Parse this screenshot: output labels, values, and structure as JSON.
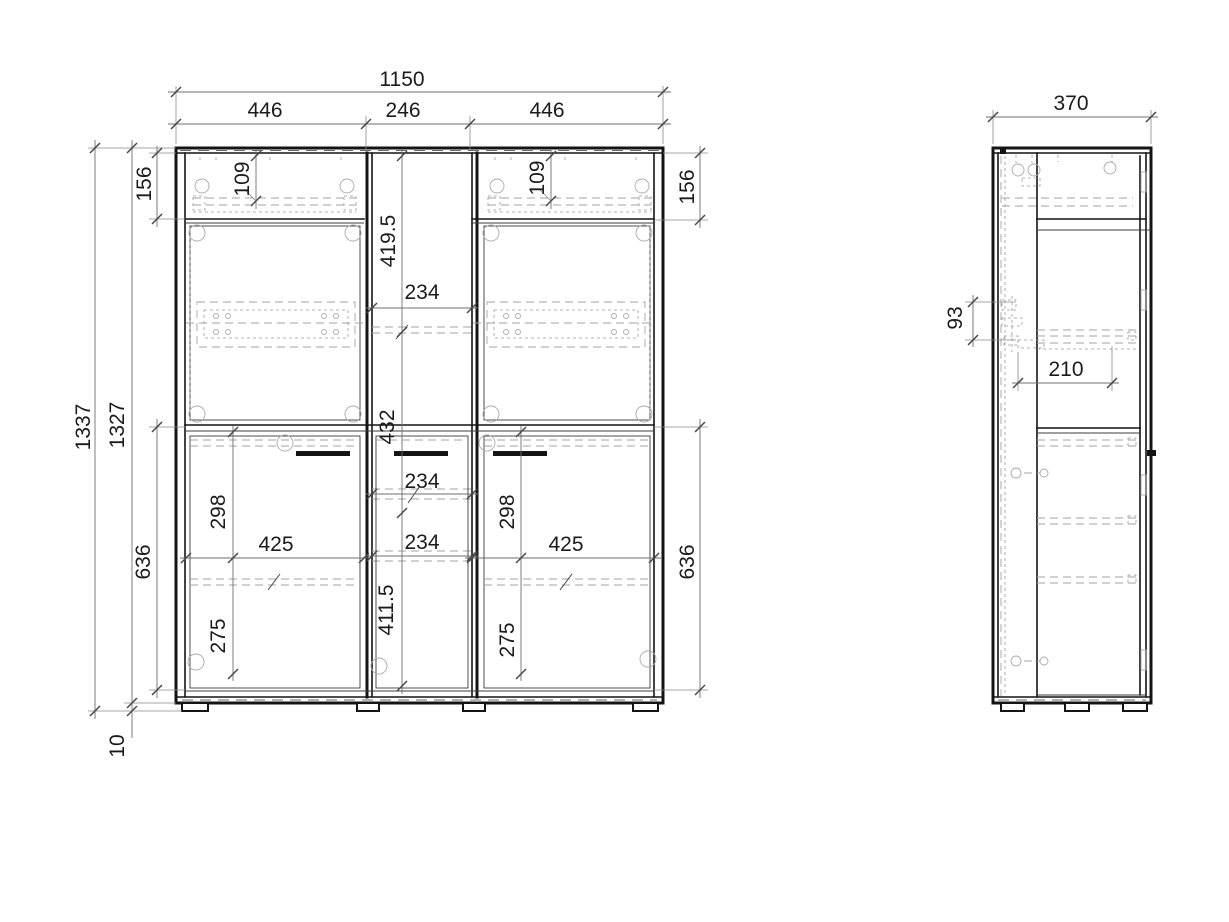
{
  "front_view": {
    "width_total": "1150",
    "width_left": "446",
    "width_center": "246",
    "width_right": "446",
    "height_total": "1337",
    "height_body": "1327",
    "height_top_section_left": "156",
    "height_top_section_right": "156",
    "drawer_left_depth": "109",
    "drawer_right_depth": "109",
    "height_bottom_section_left": "636",
    "height_bottom_section_right": "636",
    "height_feet": "10",
    "center_upper_height": "419.5",
    "center_middle_height": "432",
    "center_lower_height": "411.5",
    "center_width_upper": "234",
    "center_width_middle": "234",
    "center_width_lower": "234",
    "door_left": {
      "upper_height": "298",
      "width": "425",
      "lower_height": "275"
    },
    "door_right": {
      "upper_height": "298",
      "width": "425",
      "lower_height": "275"
    }
  },
  "side_view": {
    "depth_total": "370",
    "hinge_offset": "93",
    "shelf_depth": "210"
  },
  "colors": {
    "line": "#141414",
    "hidden_line": "#a3a3a3",
    "background": "#ffffff"
  }
}
